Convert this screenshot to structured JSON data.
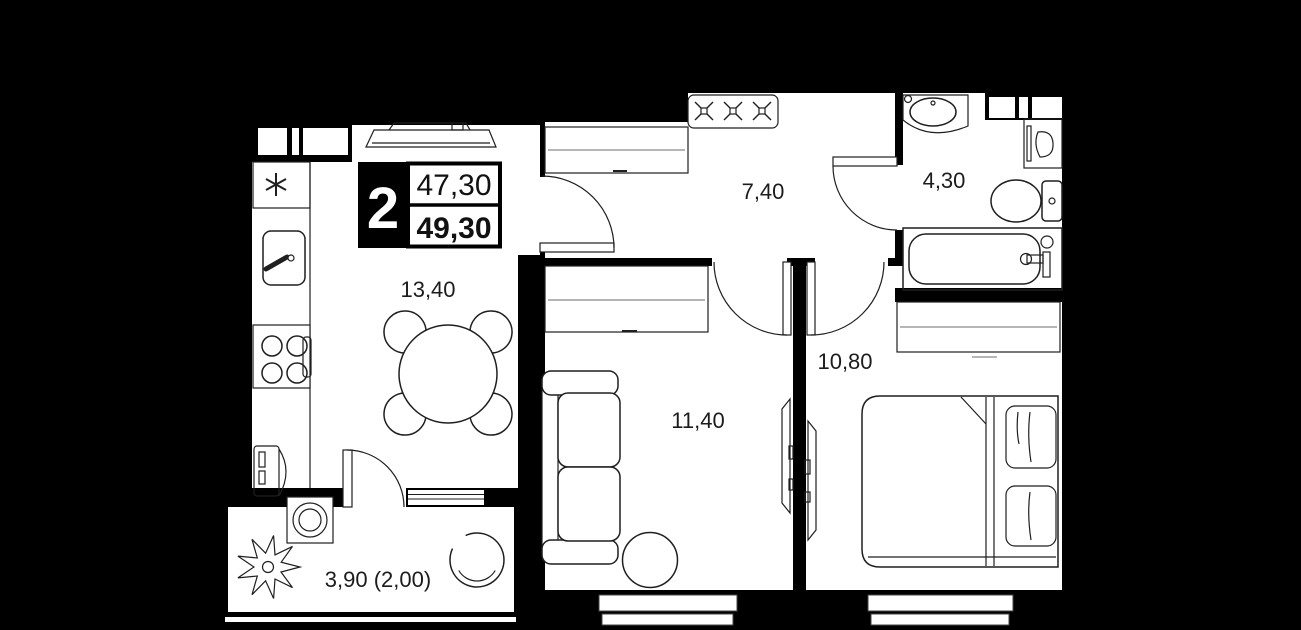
{
  "badge": {
    "rooms_count": "2",
    "area_top": "47,30",
    "area_bottom": "49,30"
  },
  "areas": {
    "kitchen_living": "13,40",
    "hallway": "7,40",
    "bathroom": "4,30",
    "bedroom": "10,80",
    "living_room": "11,40",
    "balcony": "3,90 (2,00)"
  },
  "colors": {
    "background": "#000000",
    "floor": "#ffffff",
    "wall": "#000000",
    "line": "#1f1f1f",
    "muted_line": "#9e9e9e",
    "badge_bg": "#000000",
    "badge_text": "#ffffff"
  },
  "fixtures": {
    "kitchen_living": [
      "fridge-icon",
      "sink-icon",
      "hob-icon",
      "radiator-icon",
      "cooker-hood-icon",
      "dining-table-icon",
      "chair-icon"
    ],
    "hallway": [
      "wardrobe-icon",
      "coat-hooks-icon"
    ],
    "bathroom": [
      "washbasin-icon",
      "washing-machine-icon",
      "toilet-icon",
      "bathtub-icon"
    ],
    "living_room": [
      "wardrobe-icon",
      "sofa-icon",
      "coffee-table-icon",
      "tv-icon",
      "window-icon"
    ],
    "bedroom": [
      "wardrobe-icon",
      "double-bed-icon",
      "tv-icon",
      "window-icon"
    ],
    "balcony": [
      "plant-icon",
      "stool-icon",
      "round-chair-icon"
    ]
  }
}
